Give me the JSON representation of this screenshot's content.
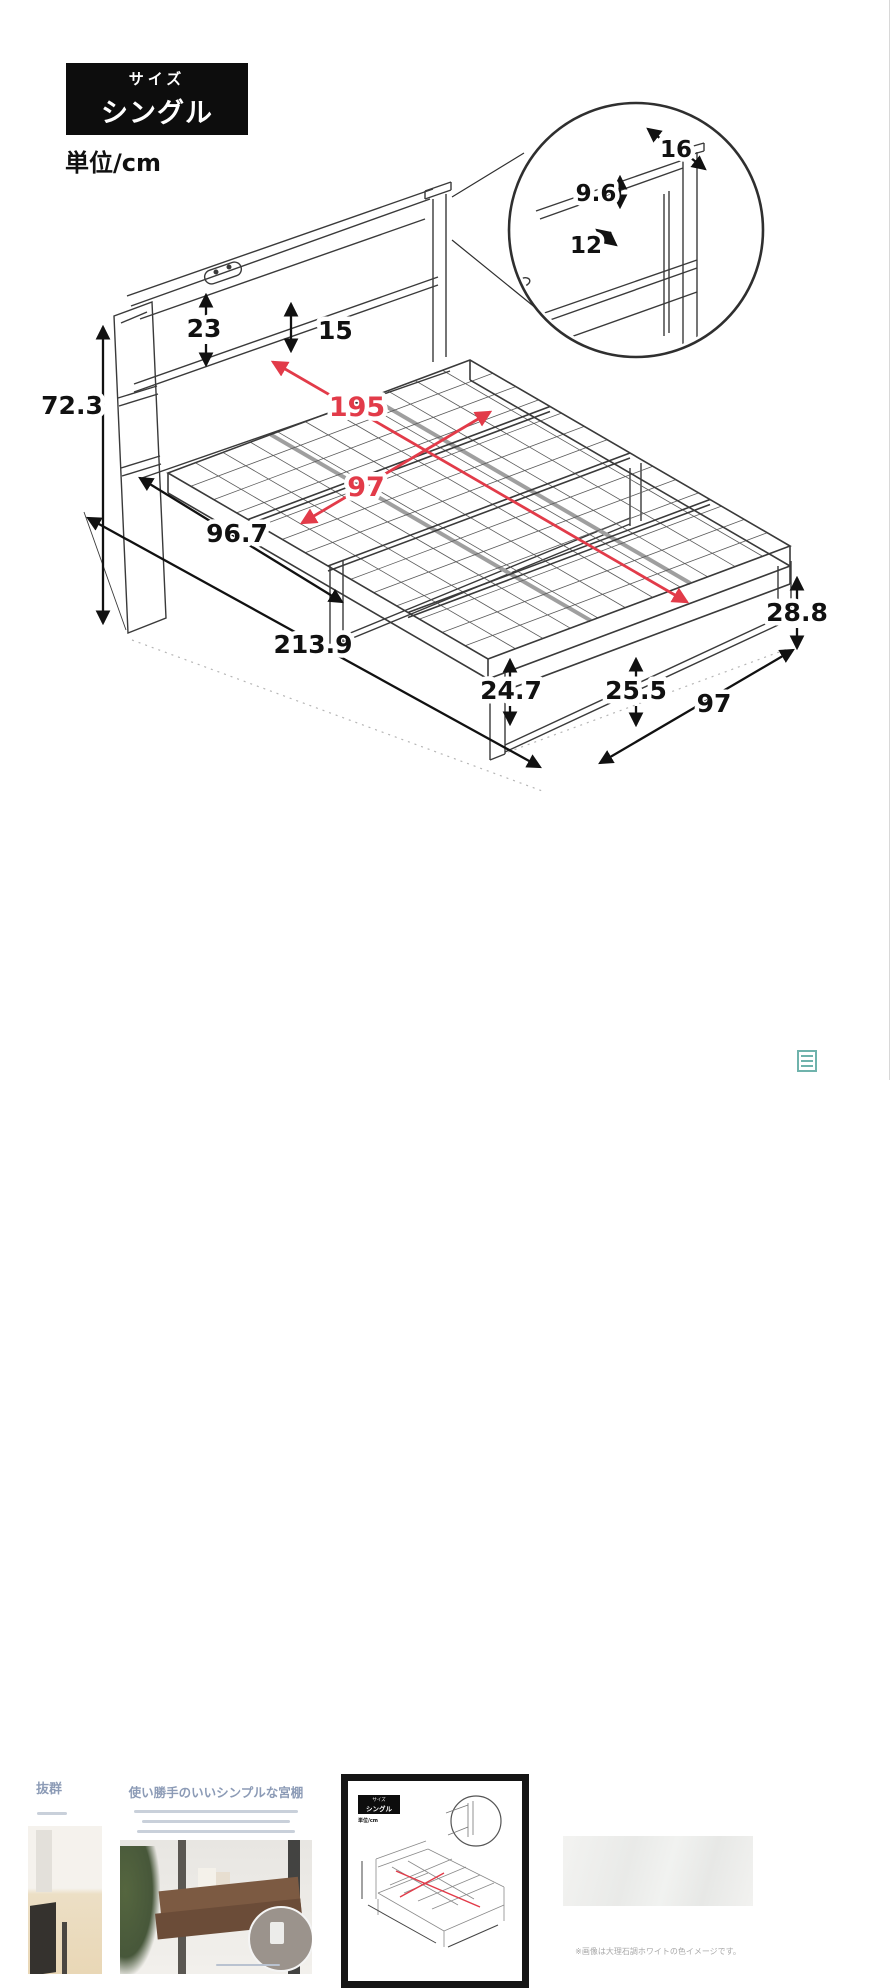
{
  "colors": {
    "accent_red": "#e23b49",
    "line": "#3a3a3a",
    "badge_bg": "#0d0d0d",
    "heading_blue": "#8c9bb6",
    "divider": "#d8d8d8",
    "watermark_teal": "#6fb3ac"
  },
  "size_badge": {
    "small": "サイズ",
    "large": "シングル"
  },
  "unit_label": "単位/cm",
  "diagram": {
    "dims": {
      "d23": "23",
      "d15": "15",
      "d72": "72.3",
      "d967": "96.7",
      "d2139": "213.9",
      "d247": "24.7",
      "d255": "25.5",
      "d97b": "97",
      "d288": "28.8",
      "r195": "195",
      "r97": "97",
      "c16": "16",
      "c96": "9.6",
      "c12": "12"
    }
  },
  "thumbnails": {
    "t1": {
      "caption": "抜群"
    },
    "t2": {
      "heading": "使い勝手のいいシンプルな宮棚"
    },
    "t3": {
      "selected": true,
      "badge_small": "サイズ",
      "badge_large": "シングル",
      "unit": "単位/cm"
    },
    "t4": {
      "caption": "※画像は大理石調ホワイトの色イメージです。"
    }
  }
}
